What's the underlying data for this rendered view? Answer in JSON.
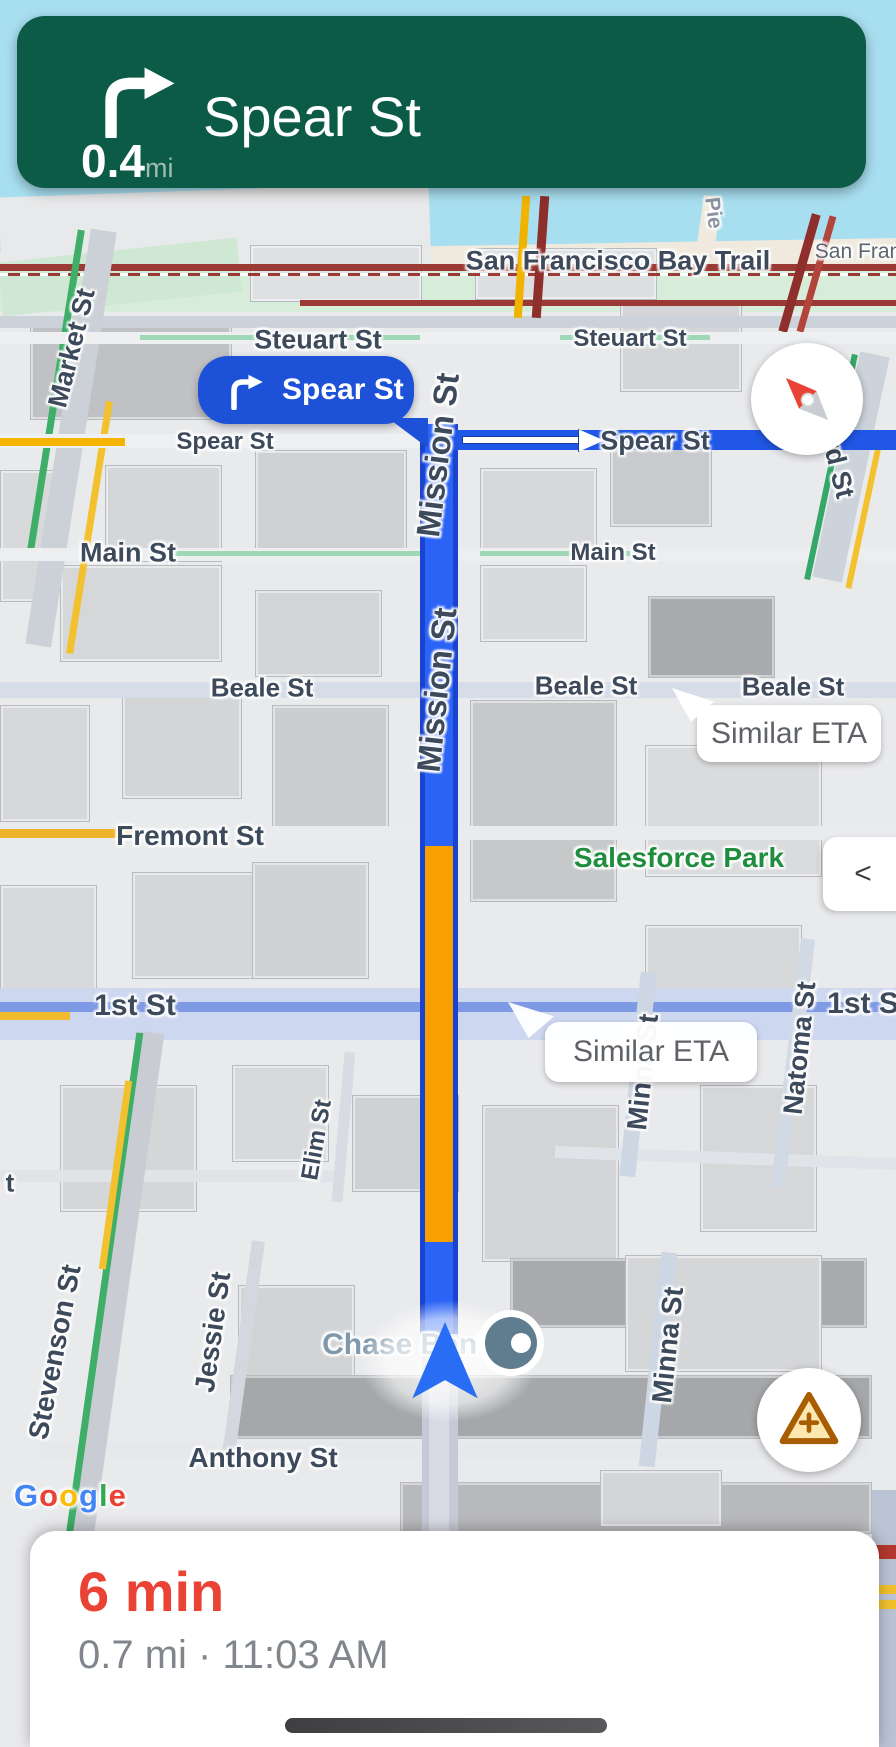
{
  "nav_banner": {
    "street": "Spear St",
    "distance": "0.4",
    "unit": "mi",
    "maneuver": "turn-right"
  },
  "turn_callout": {
    "text": "Spear St",
    "maneuver": "turn-right"
  },
  "map": {
    "street_labels": [
      {
        "text": "Pie"
      },
      {
        "text": "San Francisco Bay Trail"
      },
      {
        "text": "San Fran"
      },
      {
        "text": "Market St"
      },
      {
        "text": "Steuart St"
      },
      {
        "text": "Steuart St"
      },
      {
        "text": "Spear St"
      },
      {
        "text": "Spear St"
      },
      {
        "text": "Main St"
      },
      {
        "text": "Main St"
      },
      {
        "text": "Beale St"
      },
      {
        "text": "Beale St"
      },
      {
        "text": "Beale St"
      },
      {
        "text": "Mission St"
      },
      {
        "text": "Mission St"
      },
      {
        "text": "Fremont St"
      },
      {
        "text": "1st St"
      },
      {
        "text": "1st S"
      },
      {
        "text": "Natoma St"
      },
      {
        "text": "Elim St"
      },
      {
        "text": "Minna St"
      },
      {
        "text": "Minna St"
      },
      {
        "text": "Stevenson St"
      },
      {
        "text": "t"
      },
      {
        "text": "Jessie St"
      },
      {
        "text": "Anthony St"
      },
      {
        "text": "rd St"
      }
    ],
    "poi_labels": {
      "park": "Salesforce Park",
      "bank": "Chase Bank"
    },
    "eta_bubbles": [
      {
        "text": "Similar ETA"
      },
      {
        "text": "Similar ETA"
      }
    ],
    "attribution": {
      "text": "Google",
      "letters": [
        "G",
        "o",
        "o",
        "g",
        "l",
        "e"
      ]
    }
  },
  "controls": {
    "collapse_label": "<",
    "compass": "compass-needle",
    "report": "report-incident"
  },
  "bottom_panel": {
    "eta": "6 min",
    "distance_time": "0.7 mi · 11:03 AM"
  },
  "colors": {
    "banner_green": "#0b5b47",
    "banner_unit_gray": "#9fbdb3",
    "callout_blue": "#1d51d8",
    "route_blue": "#2a63f5",
    "route_edge_blue": "#1a43cf",
    "congestion_orange": "#f7a000",
    "spear_route_blue": "#2157e6",
    "eta_red": "#ea4335",
    "eta_sub_gray": "#80868b",
    "label_slate": "#3d4a5c",
    "park_green": "#1e8e3e",
    "water_cyan": "#a8dff0",
    "bubble_text_gray": "#5f6368",
    "report_brown": "#a85d00",
    "report_fill": "#fbe7af",
    "chase_label": "#7f98ab",
    "logo": [
      "#4285F4",
      "#EA4335",
      "#FBBC05",
      "#4285F4",
      "#34A853",
      "#EA4335"
    ]
  }
}
